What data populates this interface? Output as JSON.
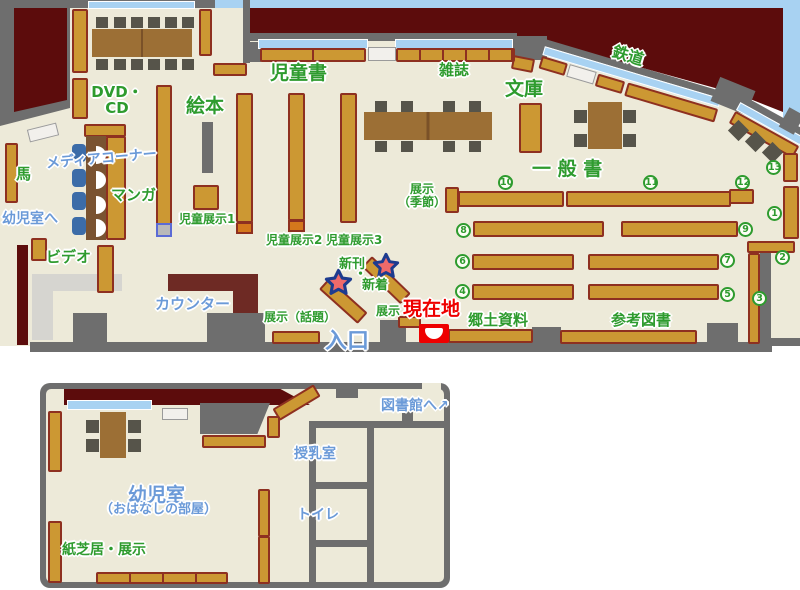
{
  "colors": {
    "floor": "#edead9",
    "outside_dark_red": "#5c0c0c",
    "outside_light_blue": "#a8d2f2",
    "wall_gray": "#6e6e6e",
    "shelf_brown": "#cc9833",
    "shelf_border": "#8e3020",
    "counter_dark_red": "#6e2a24",
    "label_green": "#2e9b2e",
    "label_blue": "#6b9ad8",
    "label_red": "#ee0000",
    "star_fill": "#ef6a6a",
    "star_border": "#1d3b8f"
  },
  "main_map": {
    "labels": {
      "dvd_line1": "DVD・",
      "dvd_line2": "CD",
      "horse": "馬",
      "media_corner": "メディアコーナー",
      "manga": "マンガ",
      "to_infant_room": "幼児室へ",
      "video": "ビデオ",
      "picture_books": "絵本",
      "children_books": "児童書",
      "children_exhibit1": "児童展示1",
      "children_exhibit2": "児童展示2",
      "children_exhibit3": "児童展示3",
      "counter": "カウンター",
      "magazines": "雑誌",
      "bunko": "文庫",
      "railway": "鉄道",
      "general_books": "一 般 書",
      "exhibit_seasonal_line1": "展示",
      "exhibit_seasonal_line2": "（季節）",
      "new_arrivals_line1": "新刊",
      "new_arrivals_dot": "・",
      "new_arrivals_line2": "新着",
      "exhibit_topics": "展示（話題）",
      "exhibit": "展示",
      "current_location": "現在地",
      "entrance": "入口",
      "local_materials": "郷土資料",
      "reference_books": "参考図書"
    },
    "shelf_numbers": [
      "1",
      "2",
      "3",
      "4",
      "5",
      "6",
      "7",
      "8",
      "9",
      "10",
      "11",
      "12",
      "13"
    ]
  },
  "lower_map": {
    "labels": {
      "to_library": "図書館へ",
      "to_library_arrow": "↗",
      "nursing_room": "授乳室",
      "toilet": "トイレ",
      "infant_room": "幼児室",
      "infant_room_sub": "（おはなしの部屋）",
      "kamishibai_exhibit": "紙芝居・展示"
    }
  }
}
